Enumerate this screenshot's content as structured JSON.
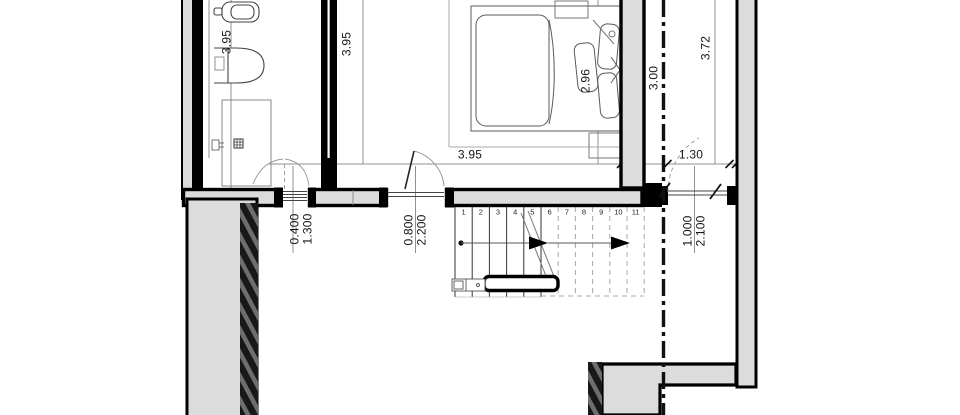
{
  "drawing": {
    "type": "architectural floor plan, upper floor with stair",
    "colors": {
      "wall_fill": "#dcdcdc",
      "wall_line": "#000000",
      "hatch_dark": "#181818",
      "hatch_base": "#6e6e6e",
      "dim_line": "#909090",
      "fixture_line": "#5a5a5a"
    }
  },
  "dims": {
    "bathroom_depth": "3.95",
    "bedroom_depth": "3.95",
    "bed_width": "2.96",
    "landing_width": "3.00",
    "right_room_depth": "3.72",
    "bedroom_width": "3.95",
    "right_door_width": "1.30",
    "window_left": {
      "w": "0.400",
      "h": "1.300"
    },
    "door_bedroom": {
      "w": "0.800",
      "h": "2.200"
    },
    "door_right": {
      "w": "1.000",
      "h": "2.100"
    }
  },
  "stairs": {
    "numbers": [
      "1",
      "2",
      "3",
      "4",
      "5",
      "6",
      "7",
      "8",
      "9",
      "10",
      "11"
    ]
  }
}
